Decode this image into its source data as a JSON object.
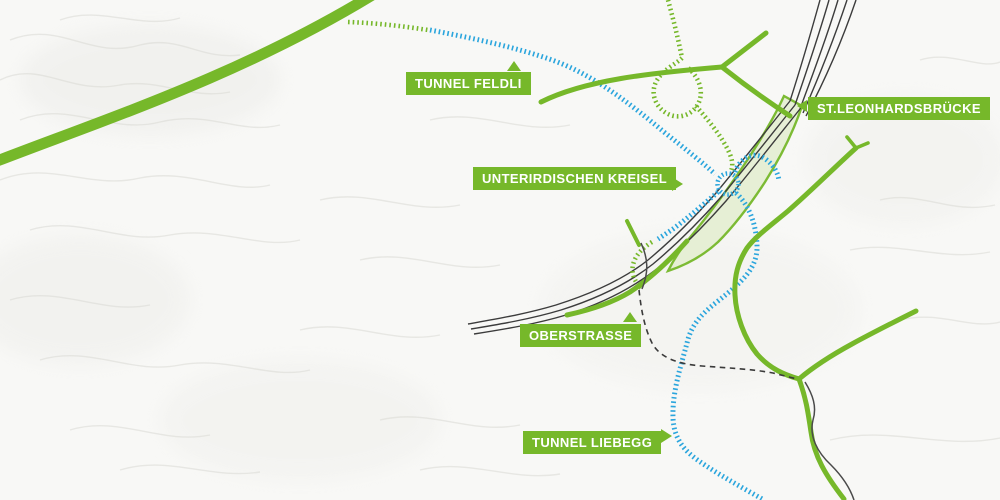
{
  "map": {
    "labels": [
      {
        "id": "tunnel-feldli",
        "text": "TUNNEL FELDLI",
        "arrow": "up"
      },
      {
        "id": "st-leonhardsbruecke",
        "text": "ST.LEONHARDSBRÜCKE",
        "arrow": "left"
      },
      {
        "id": "unterirdischer-kreisel",
        "text": "UNTERIRDISCHEN KREISEL",
        "arrow": "right"
      },
      {
        "id": "oberstrasse",
        "text": "OBERSTRASSE",
        "arrow": "up"
      },
      {
        "id": "tunnel-liebegg",
        "text": "TUNNEL LIEBEGG",
        "arrow": "right"
      }
    ],
    "colors": {
      "road_green": "#76b82a",
      "area_green": "#e6efd4",
      "tunnel_blue": "#2aa5dd",
      "rail_black": "#3c3c3c",
      "dashed_road": "#3a3a3a",
      "label_bg": "#76b82a",
      "label_text": "#ffffff",
      "background": "#f8f8f6",
      "relief_gray": "#d9d9d4"
    }
  }
}
